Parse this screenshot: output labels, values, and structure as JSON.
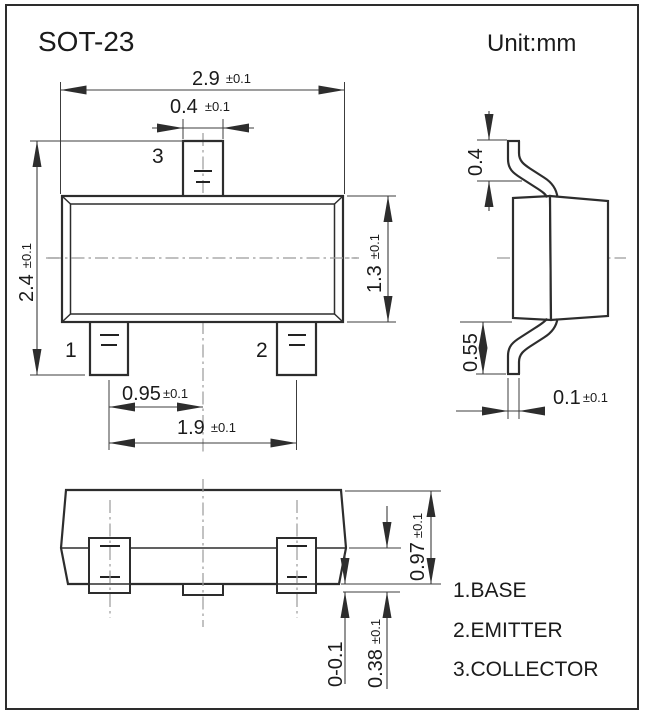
{
  "title": "SOT-23",
  "unit_label": "Unit:mm",
  "pin_labels": {
    "pin1": "1",
    "pin2": "2",
    "pin3": "3"
  },
  "dimensions": {
    "body_width": {
      "value": "2.9",
      "tol": "±0.1"
    },
    "collector_lead_width": {
      "value": "0.4",
      "tol": "±0.1"
    },
    "overall_length": {
      "value": "2.4",
      "tol": "±0.1"
    },
    "body_length": {
      "value": "1.3",
      "tol": "±0.1"
    },
    "lead_center_to_center_half": {
      "value": "0.95",
      "tol": "±0.1"
    },
    "outer_lead_span": {
      "value": "1.9",
      "tol": "±0.1"
    },
    "upper_lead_drop": {
      "value": "0.4"
    },
    "lower_lead_drop": {
      "value": "0.55"
    },
    "lead_thickness": {
      "value": "0.1",
      "tol": "±0.1"
    },
    "package_height": {
      "value": "0.97",
      "tol": "±0.1"
    },
    "standoff": {
      "value": "0-0.1"
    },
    "shoulder_height": {
      "value": "0.38",
      "tol": "±0.1"
    }
  },
  "legend": {
    "pin1": "1.BASE",
    "pin2": "2.EMITTER",
    "pin3": "3.COLLECTOR"
  },
  "colors": {
    "line": "#2d2d2d",
    "centerline": "#9a9a9a",
    "text": "#1b1b1b",
    "background": "#ffffff"
  }
}
